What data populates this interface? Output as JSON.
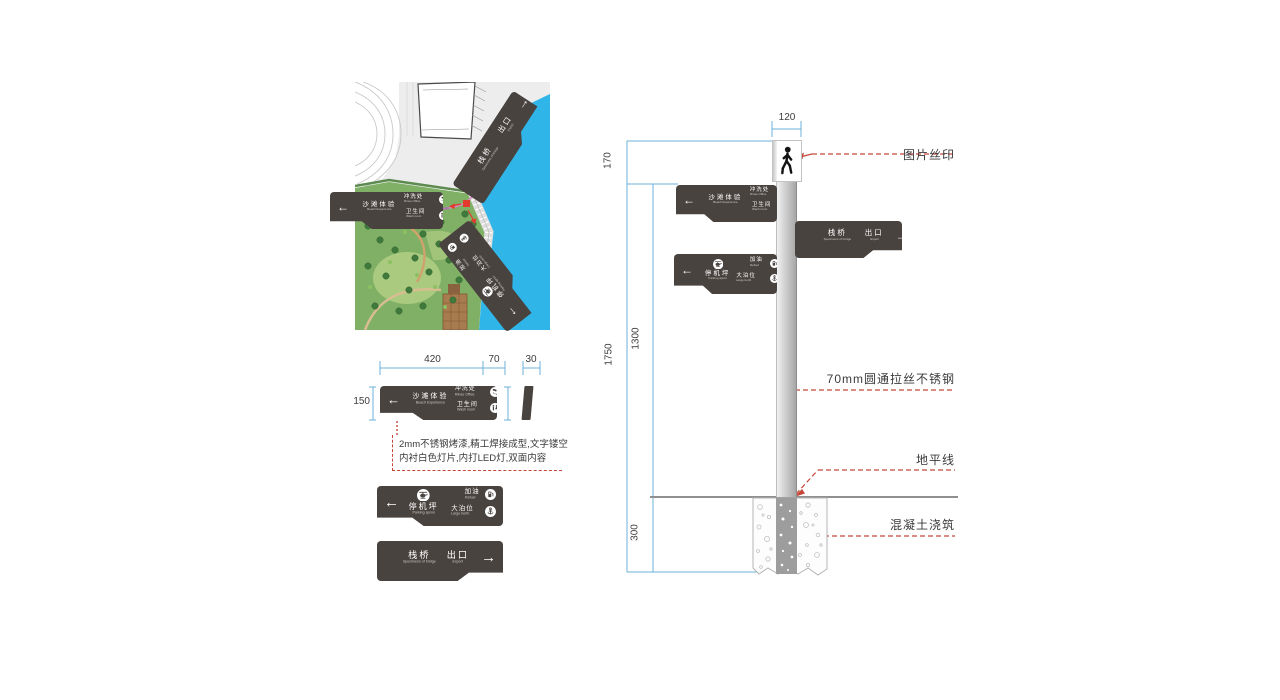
{
  "glyphs": {
    "arrow_left": "←",
    "arrow_right": "→"
  },
  "signs": {
    "beach": {
      "arrow": "left",
      "primary": {
        "zh": "沙滩体验",
        "en": "Beach Experience"
      },
      "items": [
        {
          "icon": "shower-icon",
          "zh": "冲洗处",
          "en": "Rinse Office"
        },
        {
          "icon": "toilet-icon",
          "zh": "卫生间",
          "en": "Wash room"
        }
      ]
    },
    "bridge": {
      "arrow": "right",
      "primary": {
        "zh": "栈桥",
        "en": "Specimens of bridge"
      },
      "secondary": {
        "zh": "出口",
        "en": "Export"
      }
    },
    "apron": {
      "arrow": "left",
      "icon": "helicopter-icon",
      "primary": {
        "zh": "停机坪",
        "en": "Parking apron"
      },
      "items": [
        {
          "icon": "fuel-icon",
          "zh": "加油",
          "en": "Refuel"
        },
        {
          "icon": "anchor-icon",
          "zh": "大泊位",
          "en": "Large berth"
        }
      ]
    }
  },
  "detail": {
    "dims": {
      "width_main": "420",
      "width_ext": "70",
      "thickness": "30",
      "height": "150"
    },
    "note_line1": "2mm不锈钢烤漆,精工焊接成型,文字镂空",
    "note_line2": "内衬白色灯片,内打LED灯,双面内容"
  },
  "elevation": {
    "dims": {
      "top_width": "120",
      "top_segment": "170",
      "total_height": "1750",
      "pole_height": "1300",
      "below_ground": "300"
    },
    "labels": {
      "silk_print": "图片丝印",
      "pole_material": "70mm圆通拉丝不锈钢",
      "ground_line": "地平线",
      "concrete": "混凝土浇筑"
    },
    "pictogram_icon": "pedestrian-icon"
  },
  "colors": {
    "sign_dark": "#494340",
    "dimension_blue": "#6cb1d8",
    "leader_red": "#c5473a",
    "water_blue": "#2fb5e8",
    "park_green": "#7fb065"
  }
}
